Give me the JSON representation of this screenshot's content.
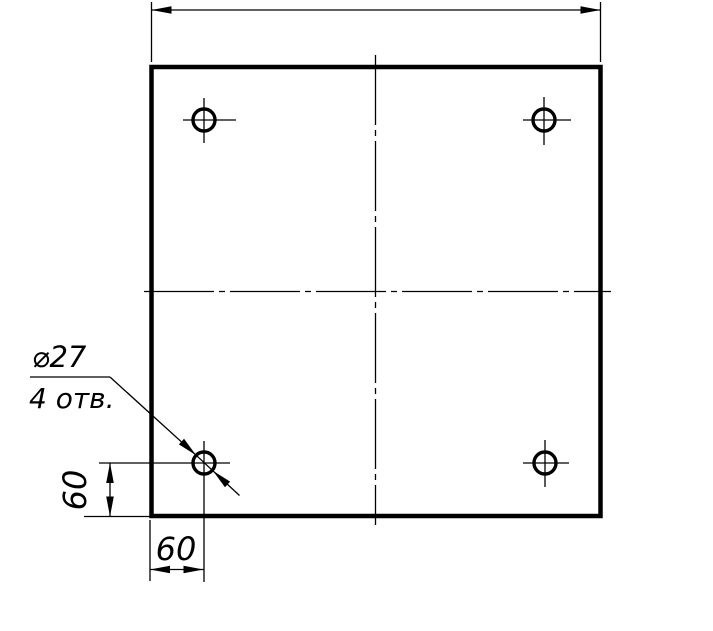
{
  "drawing": {
    "type": "engineering-drawing",
    "description": "Square plate top view with four drilled holes, GOST-style dimensioning",
    "background": "#ffffff",
    "line_color": "#000000",
    "labels": {
      "hole_diameter": "⌀27",
      "hole_count": "4 отв.",
      "dim_left": "60",
      "dim_bottom": "60"
    },
    "plate": {
      "x": 151.5,
      "y": 67,
      "width": 449,
      "height": 449,
      "stroke_width": 4.5
    },
    "centerlines": {
      "dash": "70 5 6 5",
      "vertical": {
        "x": 375.5,
        "y1": 55,
        "y2": 525
      },
      "horizontal": {
        "y": 291.5,
        "x1": 144,
        "x2": 611
      }
    },
    "holes": {
      "radius": 11,
      "stroke_width": 3.4,
      "items": [
        {
          "id": "top-left",
          "cx": 204,
          "cy": 120,
          "h": [
            183,
            236
          ],
          "v": [
            98,
            143
          ]
        },
        {
          "id": "top-right",
          "cx": 544,
          "cy": 120,
          "h": [
            523,
            571
          ],
          "v": [
            97,
            145
          ]
        },
        {
          "id": "bottom-left",
          "cx": 204,
          "cy": 463,
          "h": [
            99,
            230
          ],
          "v": [
            441,
            582
          ]
        },
        {
          "id": "bottom-right",
          "cx": 545,
          "cy": 463,
          "h": [
            523,
            569
          ],
          "v": [
            440,
            487
          ]
        }
      ]
    },
    "dim_top": {
      "ext": [
        [
          151.5,
          2,
          151.5,
          62
        ],
        [
          600.5,
          2,
          600.5,
          62
        ]
      ],
      "line": [
        151.5,
        10,
        600.5,
        10
      ]
    },
    "dim_left": {
      "ext": [
        [
          84,
          516.5,
          150,
          516.5
        ]
      ],
      "line": [
        110,
        463,
        110,
        516.5
      ]
    },
    "dim_bottom": {
      "ext": [
        [
          150,
          520,
          150,
          581
        ]
      ],
      "line": [
        150,
        569.5,
        203.5,
        569.5
      ]
    },
    "leader": {
      "underline": [
        30,
        377,
        110,
        377
      ],
      "to_circle": [
        110,
        377,
        196.1,
        455.2
      ],
      "through_circle": [
        196.1,
        455.2,
        212.9,
        470.8
      ],
      "tail": [
        212.9,
        470.8,
        239.5,
        495.5
      ],
      "arrows": [
        {
          "x": 196.1,
          "y": 455.2,
          "angle": 42.9
        },
        {
          "x": 212.9,
          "y": 470.8,
          "angle": 222.9
        }
      ]
    },
    "arrow": {
      "length": 20,
      "half_width": 3.8
    },
    "thin_stroke": 1.3
  }
}
